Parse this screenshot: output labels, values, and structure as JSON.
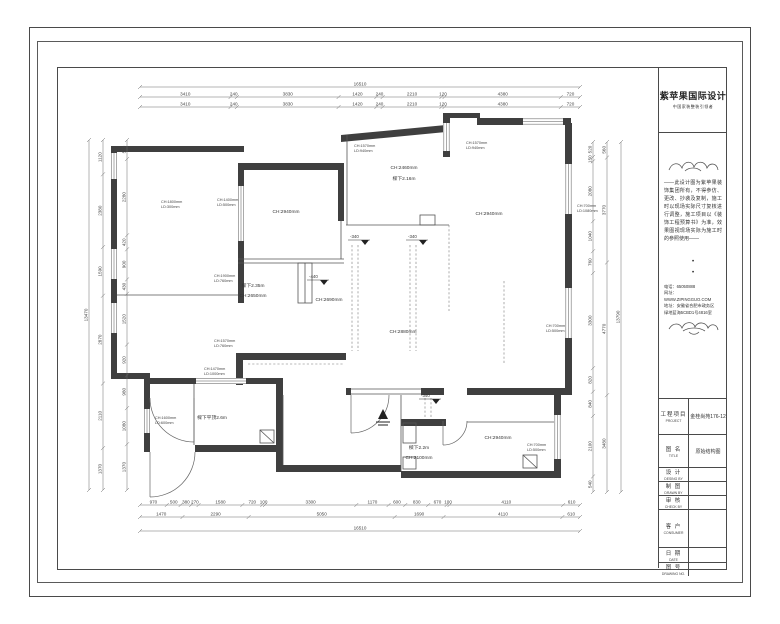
{
  "brand": {
    "name": "紫苹果国际设计",
    "tagline": "中国家装整装引领者"
  },
  "disclaimer": "——此设计图为紫苹果装饰集团所有，不得参仿、更改、抄袭及复制，施工时以现场实际尺寸复核进行调整，施工项目以《装饰工程预算书》为准，效果图视现场实际为施工时的参照使用——",
  "contact": {
    "phone": "电话：65050888",
    "web": "网址：WWW.ZIPINGGUO.COM",
    "addr1": "地址：安徽省合肥市政务区",
    "addr2": "绿地蓝海5CBD1号4816室"
  },
  "misc": {
    "dot": "•"
  },
  "title_block": {
    "rows": [
      {
        "zh": "工程项目",
        "en": "PROJECT",
        "value": "金桂尚苑176-12"
      },
      {
        "zh": "图 名",
        "en": "TITLE",
        "value": "原始结构图"
      },
      {
        "zh": "设 计",
        "en": "DESING BY",
        "value": ""
      },
      {
        "zh": "制 图",
        "en": "DRAWN BY",
        "value": ""
      },
      {
        "zh": "审 核",
        "en": "CHECK BY",
        "value": ""
      },
      {
        "zh": "客 户",
        "en": "CONSUMER",
        "value": ""
      },
      {
        "zh": "日 期",
        "en": "DATE",
        "value": ""
      },
      {
        "zh": "图 号",
        "en": "DRAWING NO.",
        "value": ""
      }
    ]
  },
  "dimensions": {
    "top_total": "16510",
    "top_row1": [
      "3410",
      "240",
      "3830",
      "1420",
      "240",
      "2210",
      "120",
      "4380",
      "720"
    ],
    "top_row2": [
      "3410",
      "240",
      "3830",
      "1420",
      "240",
      "2210",
      "120",
      "4380",
      "720"
    ],
    "bottom_row1": [
      "970",
      "500",
      "380",
      "270",
      "1580",
      "720",
      "100",
      "3300",
      "1170",
      "600",
      "830",
      "670",
      "100",
      "4110",
      "610"
    ],
    "bottom_row2": [
      "1470",
      "2290",
      "5050",
      "1690",
      "4110",
      "610"
    ],
    "bottom_total": "16510",
    "left_outer_total": "13470",
    "left_col1": [
      "1120",
      "2380",
      "1590",
      "2870",
      "2110",
      "1370"
    ],
    "left_col2": [
      "570",
      "2280",
      "420",
      "900",
      "430",
      "1520",
      "920",
      "980",
      "1080",
      "1370"
    ],
    "right_col1": [
      "520",
      "150",
      "2080",
      "1040",
      "760",
      "3300",
      "820",
      "840",
      "2100",
      "540"
    ],
    "right_col2": [
      "560",
      "3770",
      "4770",
      "3480"
    ],
    "right_total": "13790"
  },
  "rooms": [
    {
      "label": "CH:2940mm"
    },
    {
      "label": "CH:2460mm"
    },
    {
      "label": "樑下2.16m"
    },
    {
      "label": "CH:2940mm"
    },
    {
      "label": "CH:2880mm"
    },
    {
      "label": "樑下2.35m"
    },
    {
      "label": "CH:2650mm"
    },
    {
      "label": "CH:2690mm"
    },
    {
      "label": "樑下平顶2.6m"
    },
    {
      "label": "CH:2940mm"
    },
    {
      "label": "樑下2.2m"
    },
    {
      "label": "CH:2100mm"
    }
  ],
  "window_annotations": [
    {
      "l1": "CH:1800mm",
      "l2": "LD:300mm"
    },
    {
      "l1": "CH:1400mm",
      "l2": "LD:500mm"
    },
    {
      "l1": "CH:1570mm",
      "l2": "LD:940mm"
    },
    {
      "l1": "CH:1570mm",
      "l2": "LD:940mm"
    },
    {
      "l1": "CH:700mm",
      "l2": "LD:1080mm"
    },
    {
      "l1": "CH:700mm",
      "l2": "LD:500mm"
    },
    {
      "l1": "CH:1900mm",
      "l2": "LD:760mm"
    },
    {
      "l1": "CH:1570mm",
      "l2": "LD:760mm"
    },
    {
      "l1": "CH:1470mm",
      "l2": "LD:1000mm"
    },
    {
      "l1": "CH:1600mm",
      "l2": "LD:600mm"
    },
    {
      "l1": "CH:700mm",
      "l2": "LD:500mm"
    }
  ],
  "level_markers": [
    {
      "label": "-340"
    },
    {
      "label": "-340"
    },
    {
      "label": "-340"
    },
    {
      "label": "-440"
    }
  ]
}
